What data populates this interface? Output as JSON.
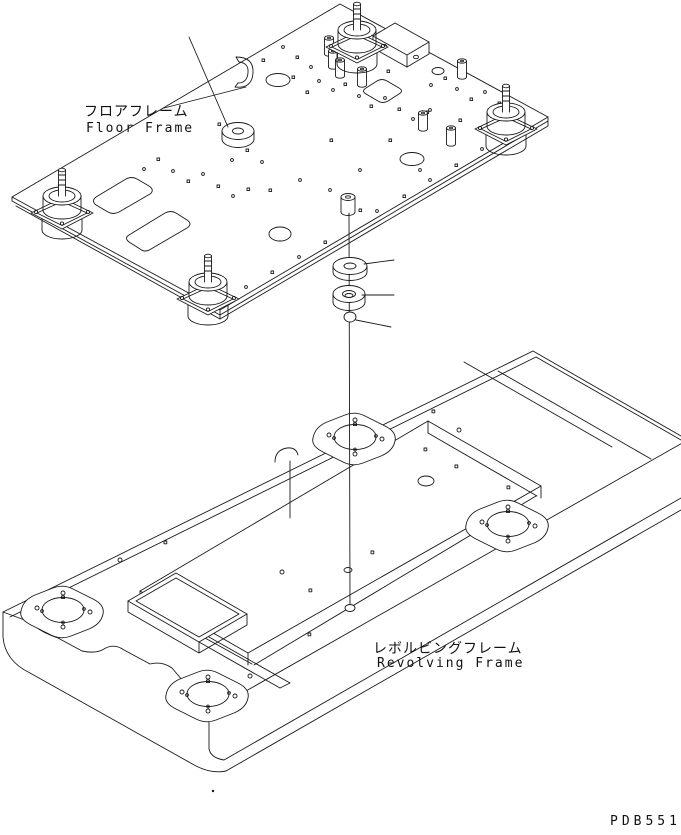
{
  "drawing": {
    "code": "PDB5517",
    "labels": {
      "floor_frame_ja": "フロアフレーム",
      "floor_frame_en": "Floor Frame",
      "revolving_frame_ja": "レボルビングフレーム",
      "revolving_frame_en": "Revolving Frame"
    },
    "colors": {
      "line": "#1a1a1a",
      "background": "#ffffff"
    },
    "components": {
      "upper_assembly": "floor-frame-plate-with-viscous-mounts",
      "middle_parts": [
        "sleeve",
        "plain-washer",
        "thick-washer",
        "pin"
      ],
      "lower_assembly": "revolving-frame-deck-with-mount-bosses"
    }
  }
}
